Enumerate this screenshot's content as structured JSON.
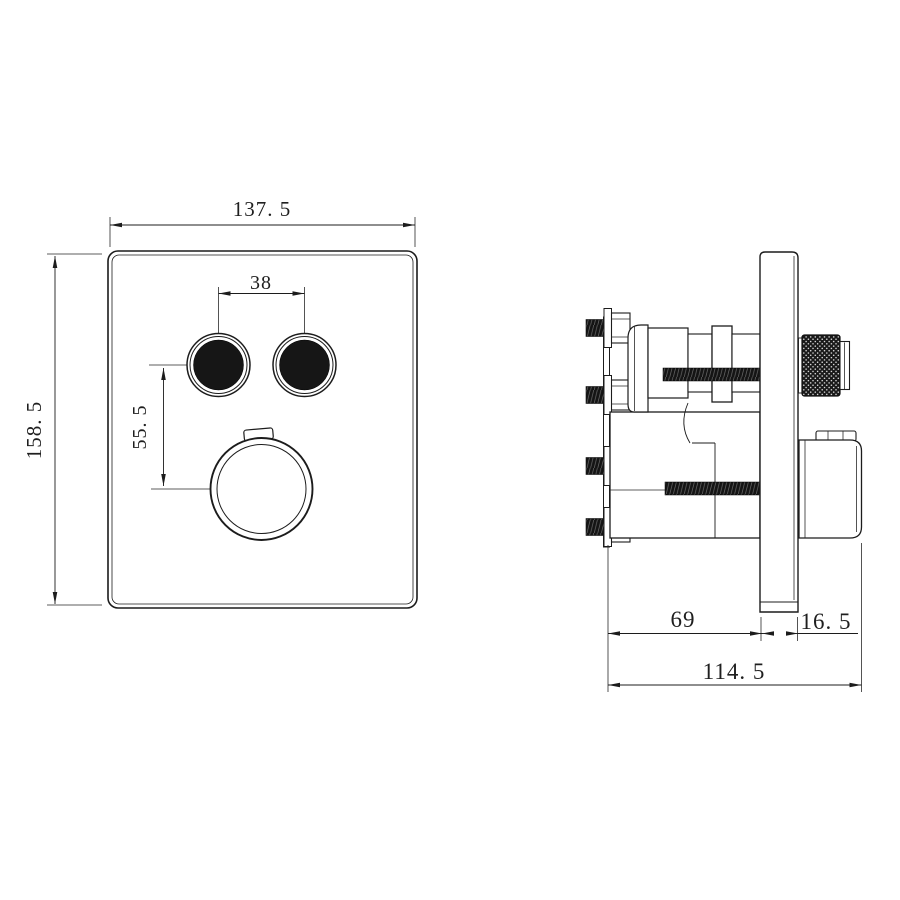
{
  "drawing": {
    "front_view": {
      "labels": {
        "panel_width": "137. 5",
        "panel_height": "158. 5",
        "button_spacing": "38",
        "button_to_knob": "55. 5"
      }
    },
    "side_view": {
      "labels": {
        "body_depth": "69",
        "trim_depth": "16. 5",
        "total_depth": "114. 5"
      }
    },
    "colors": {
      "background": "#ffffff",
      "line": "#1c1c1c",
      "solid_black": "#161616"
    }
  }
}
